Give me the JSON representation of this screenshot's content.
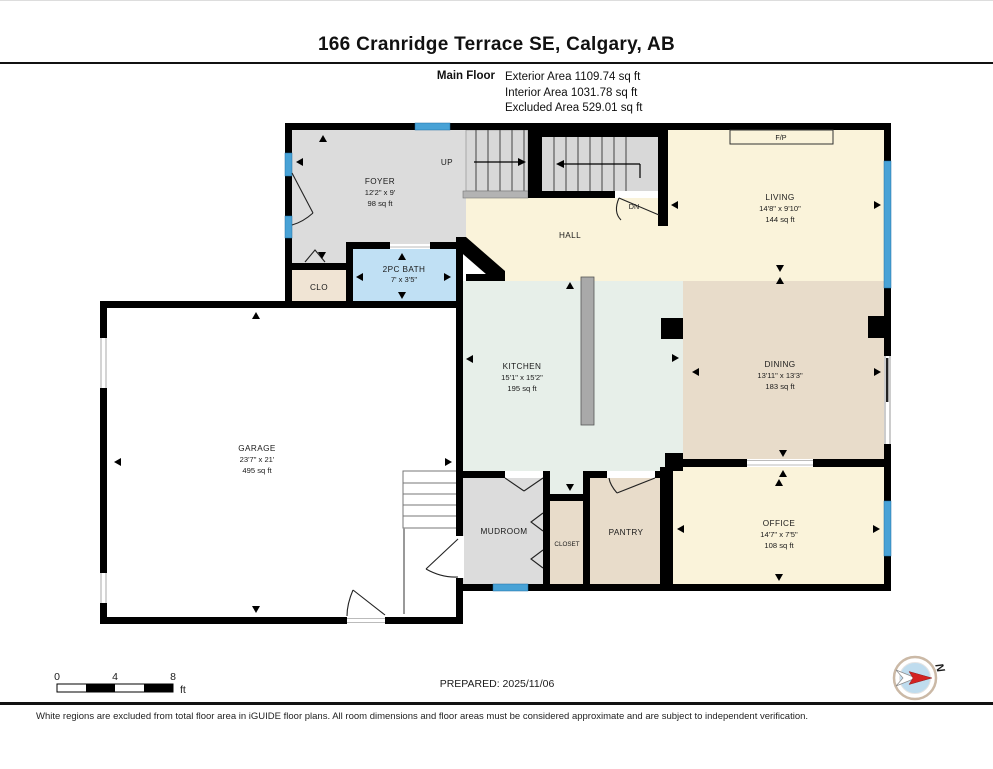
{
  "header": {
    "title": "166 Cranridge Terrace SE, Calgary, AB",
    "floor_label": "Main Floor",
    "exterior_area": "Exterior Area 1109.74 sq ft",
    "interior_area": "Interior Area 1031.78 sq ft",
    "excluded_area": "Excluded Area 529.01 sq ft"
  },
  "rooms": {
    "foyer": {
      "name": "FOYER",
      "dims": "12'2\" x 9'",
      "area": "98 sq ft"
    },
    "bath": {
      "name": "2PC BATH",
      "dims": "7' x 3'5\""
    },
    "clo": {
      "name": "CLO"
    },
    "hall": {
      "name": "HALL"
    },
    "living": {
      "name": "LIVING",
      "dims": "14'8\" x 9'10\"",
      "area": "144 sq ft"
    },
    "kitchen": {
      "name": "KITCHEN",
      "dims": "15'1\" x 15'2\"",
      "area": "195 sq ft"
    },
    "dining": {
      "name": "DINING",
      "dims": "13'11\" x 13'3\"",
      "area": "183 sq ft"
    },
    "garage": {
      "name": "GARAGE",
      "dims": "23'7\" x 21'",
      "area": "495 sq ft"
    },
    "mudroom": {
      "name": "MUDROOM"
    },
    "closet": {
      "name": "CLOSET"
    },
    "pantry": {
      "name": "PANTRY"
    },
    "office": {
      "name": "OFFICE",
      "dims": "14'7\" x 7'5\"",
      "area": "108 sq ft"
    }
  },
  "labels": {
    "up": "UP",
    "dn": "DN",
    "fp": "F/P"
  },
  "footer": {
    "scale_0": "0",
    "scale_4": "4",
    "scale_8": "8",
    "scale_unit": "ft",
    "prepared": "PREPARED: 2025/11/06",
    "compass_n": "N",
    "disclaimer": "White regions are excluded from total floor area in iGUIDE floor plans. All room dimensions and floor areas must be considered approximate and are subject to independent verification."
  },
  "colors": {
    "wall": "#000000",
    "window": "#48a2d6",
    "cream": "#faf3da",
    "tan": "#e8dcca",
    "mint": "#e7efe9",
    "gray_room": "#dcdcdc",
    "bath_blue": "#c0e0f4",
    "clo_beige": "#f0e4d4",
    "stair": "#d8d8d8",
    "island": "#a9a9a9",
    "compass_red": "#d42221"
  }
}
